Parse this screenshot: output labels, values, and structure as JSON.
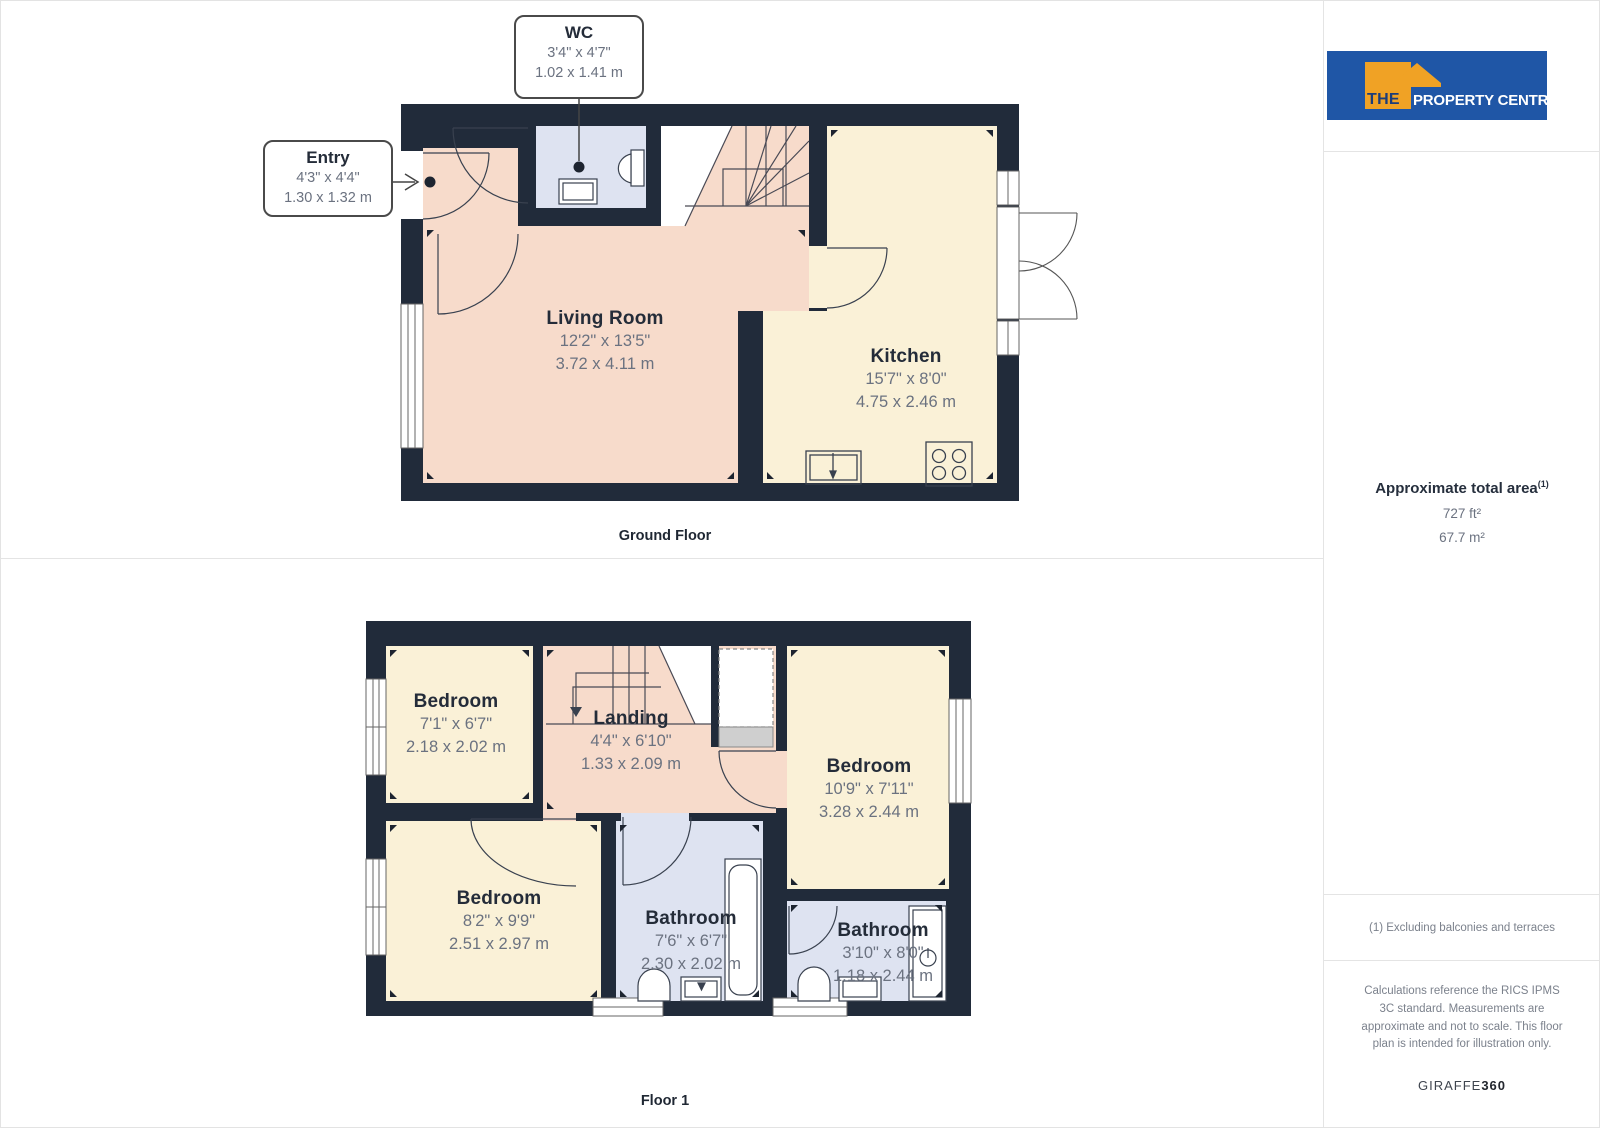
{
  "branding": {
    "the": "THE",
    "rest": "PROPERTY CENTRE"
  },
  "floors": [
    {
      "label": "Ground Floor",
      "callouts": [
        {
          "name": "WC",
          "imperial": "3'4\" x 4'7\"",
          "metric": "1.02 x 1.41 m"
        },
        {
          "name": "Entry",
          "imperial": "4'3\" x 4'4\"",
          "metric": "1.30 x 1.32 m"
        }
      ],
      "rooms": [
        {
          "name": "Living Room",
          "imperial": "12'2\" x 13'5\"",
          "metric": "3.72 x 4.11 m"
        },
        {
          "name": "Kitchen",
          "imperial": "15'7\" x 8'0\"",
          "metric": "4.75 x 2.46 m"
        }
      ]
    },
    {
      "label": "Floor 1",
      "rooms": [
        {
          "name": "Bedroom",
          "imperial": "7'1\" x 6'7\"",
          "metric": "2.18 x 2.02 m"
        },
        {
          "name": "Landing",
          "imperial": "4'4\" x 6'10\"",
          "metric": "1.33 x 2.09 m"
        },
        {
          "name": "Bedroom",
          "imperial": "10'9\" x 7'11\"",
          "metric": "3.28 x 2.44 m"
        },
        {
          "name": "Bedroom",
          "imperial": "8'2\" x 9'9\"",
          "metric": "2.51 x 2.97 m"
        },
        {
          "name": "Bathroom",
          "imperial": "7'6\" x 6'7\"",
          "metric": "2.30 x 2.02 m"
        },
        {
          "name": "Bathroom",
          "imperial": "3'10\" x 8'0\"",
          "metric": "1.18 x 2.44 m"
        }
      ]
    }
  ],
  "sidebar": {
    "area_title": "Approximate total area",
    "area_superscript": "(1)",
    "area_imperial": "727 ft²",
    "area_metric": "67.7 m²",
    "footnote": "(1) Excluding balconies and terraces",
    "disclaimer": "Calculations reference the RICS IPMS 3C standard. Measurements are approximate and not to scale. This floor plan is intended for illustration only.",
    "credit_brand": "GIRAFFE",
    "credit_suffix": "360"
  },
  "colors": {
    "wall": "#212b3a",
    "room_pink": "#f7dbcb",
    "room_cream": "#faf1d7",
    "room_blue": "#dee3f1",
    "logo_blue": "#1f56a6",
    "logo_orange": "#f0a225"
  }
}
